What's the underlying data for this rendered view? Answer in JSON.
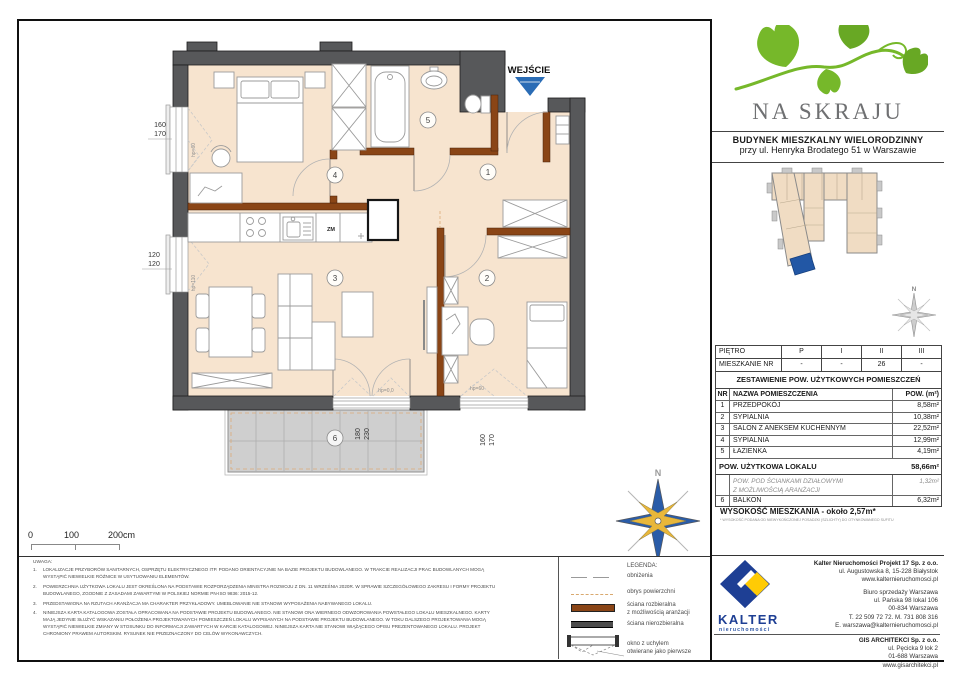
{
  "header": {
    "project_name": "NA SKRAJU",
    "building_line1": "BUDYNEK MIESZKALNY WIELORODZINNY",
    "building_line2": "przy ul. Henryka Brodatego 51 w Warszawie"
  },
  "plan": {
    "entrance_label": "WEJŚCIE",
    "zm_label": "ZM",
    "compass_n": "N",
    "rooms": [
      "1",
      "2",
      "3",
      "4",
      "5",
      "6"
    ],
    "dims": {
      "left_top_a": "160",
      "left_top_b": "170",
      "left_bottom_a": "120",
      "left_bottom_b": "120",
      "balcony_a": "180",
      "balcony_b": "230",
      "bottom_right_a": "160",
      "bottom_right_b": "170"
    },
    "hp": {
      "left_top": "hp=60",
      "left_bottom": "hp=110",
      "balcony": "hp=0,0",
      "bottom_right": "hp=60"
    }
  },
  "siteplan": {
    "compass_n": "N"
  },
  "floor_table": {
    "floor_label": "PIĘTRO",
    "floors": [
      "P",
      "I",
      "II",
      "III"
    ],
    "apt_label": "MIESZKANIE NR",
    "apt_values": [
      "-",
      "-",
      "26",
      "-"
    ]
  },
  "area_table": {
    "title": "ZESTAWIENIE POW. UŻYTKOWYCH POMIESZCZEŃ",
    "col_nr": "NR",
    "col_name": "NAZWA POMIESZCZENIA",
    "col_area": "POW. (m²)",
    "rows": [
      {
        "nr": "1",
        "name": "PRZEDPOKÓJ",
        "area": "8,58m²"
      },
      {
        "nr": "2",
        "name": "SYPIALNIA",
        "area": "10,38m²"
      },
      {
        "nr": "3",
        "name": "SALON Z ANEKSEM KUCHENNYM",
        "area": "22,52m²"
      },
      {
        "nr": "4",
        "name": "SYPIALNIA",
        "area": "12,99m²"
      },
      {
        "nr": "5",
        "name": "ŁAZIENKA",
        "area": "4,19m²"
      }
    ],
    "total_label": "POW. UŻYTKOWA LOKALU",
    "total_area": "58,66m²",
    "partition_line1": "POW. POD ŚCIANKAMI DZIAŁOWYMI",
    "partition_line2": "Z MOŻLIWOŚCIĄ ARANŻACJI",
    "partition_area": "1,32m²",
    "balcony_nr": "6",
    "balcony_label": "BALKON",
    "balcony_area": "6,32m²",
    "height_label": "WYSOKOŚĆ MIESZKANIA - około 2,57m*",
    "height_note": "* WYSOKOŚĆ PODANA OD NIEWYKOŃCZONEJ POSADZKI (SZLICHTY) DO OTYNKOWANEGO SUFITU"
  },
  "scale_bar": {
    "t0": "0",
    "t100": "100",
    "t200": "200cm"
  },
  "notes": {
    "title": "UWAGA:",
    "items": [
      {
        "num": "1.",
        "text": "LOKALIZACJE PRZYBORÓW SANITARNYCH, OSPRZĘTU ELEKTRYCZNEGO ITP. PODANO ORIENTACYJNIE NA BAZIE PROJEKTU BUDOWLANEGO. W TRAKCIE REALIZACJI PRAC BUDOWLANYCH MOGĄ WYSTĄPIĆ NIEWIELKIE RÓŻNICE W USYTUOWANIU ELEMENTÓW."
      },
      {
        "num": "2.",
        "text": "POWIERZCHNIA UŻYTKOWA LOKALU JEST OKREŚLONA NA PODSTAWIE ROZPORZĄDZENIA MINISTRA ROZWOJU Z DN. 11 WRZEŚNIA 2020R. W SPRAWIE SZCZEGÓŁOWEGO ZAKRESU I FORMY PROJEKTU BUDOWLANEGO, ZGODNIE Z ZASADAMI ZAWARTYMI W POLSKIEJ NORMIE PN-ISO 9836: 2015-12."
      },
      {
        "num": "3.",
        "text": "PRZEDSTAWIONA NA RZUTACH ARANŻACJA MA CHARAKTER PRZYKŁADOWY. UMEBLOWANIE NIE STANOWI WYPOSAŻENIA NABYWANEGO LOKALU."
      },
      {
        "num": "4.",
        "text": "NINIEJSZA KARTA KATALOGOWA ZOSTAŁA OPRACOWANA NA PODSTAWIE PROJEKTU BUDOWLANEGO. NIE STANOWI ONA WIERNEGO ODWZOROWANIA POWSTAŁEGO LOKALU MIESZKALNEGO. KARTY MAJĄ JEDYNIE SŁUŻYĆ WSKAZANIU POŁOŻENIA PROJEKTOWANYCH POMIESZCZEŃ LOKALU WYPISANYCH NA PODSTAWIE PROJEKTU BUDOWLANEGO. W TOKU DALSZEGO PROJEKTOWANIA MOGĄ WYSTĄPIĆ NIEWIELKIE ZMIANY W STOSUNKU DO INFORMACJI ZAWARTYCH W KARCIE KATALOGOWEJ. NINIEJSZA KARTA NIE STANOWI WIĄŻĄCEGO OPISU PREZENTOWANEGO LOKALU. PROJEKT CHRONIONY PRAWEM AUTORSKIM. RYSUNEK NIE PRZEZNACZONY DO CELÓW WYKONAWCZYCH."
      }
    ]
  },
  "legend": {
    "title": "LEGENDA:",
    "obnizenia": "obniżenia",
    "obrys": "obrys powierzchni",
    "rozbieralna_1": "ściana rozbieralna",
    "rozbieralna_2": "z możliwością aranżacji",
    "nierozbieralna": "ściana nierozbieralna",
    "okno_1": "okno z uchylem",
    "okno_2": "otwierane jako pierwsze"
  },
  "contacts": {
    "logo_name": "KALTER",
    "logo_sub": "nieruchomości",
    "block1": [
      "Kalter Nieruchomości Projekt 17 Sp. z o.o.",
      "ul. Augustowska 8, 15-228 Białystok",
      "www.kalternieruchomosci.pl"
    ],
    "block2": [
      "Biuro sprzedaży Warszawa",
      "ul. Pańska 98 lokal 106",
      "00-834 Warszawa",
      "T. 22 509 72 72. M. 731 808 316",
      "E. warszawa@kalternieruchomosci.pl"
    ],
    "block3": [
      "GIS ARCHITEKCI Sp. z o.o.",
      "ul. Pęcicka 9 lok 2",
      "01-688 Warszawa",
      "www.gisarchitekci.pl"
    ]
  },
  "colors": {
    "floor_beige": "#f7e4cf",
    "wall_dark": "#57585a",
    "wall_brown": "#8a4516",
    "accent_blue": "#2a6cb5",
    "brand_green": "#76b82a",
    "kalter_navy": "#1e3f94",
    "kalter_yellow": "#ffcb05",
    "balcony_gray": "#cfcfcf"
  }
}
